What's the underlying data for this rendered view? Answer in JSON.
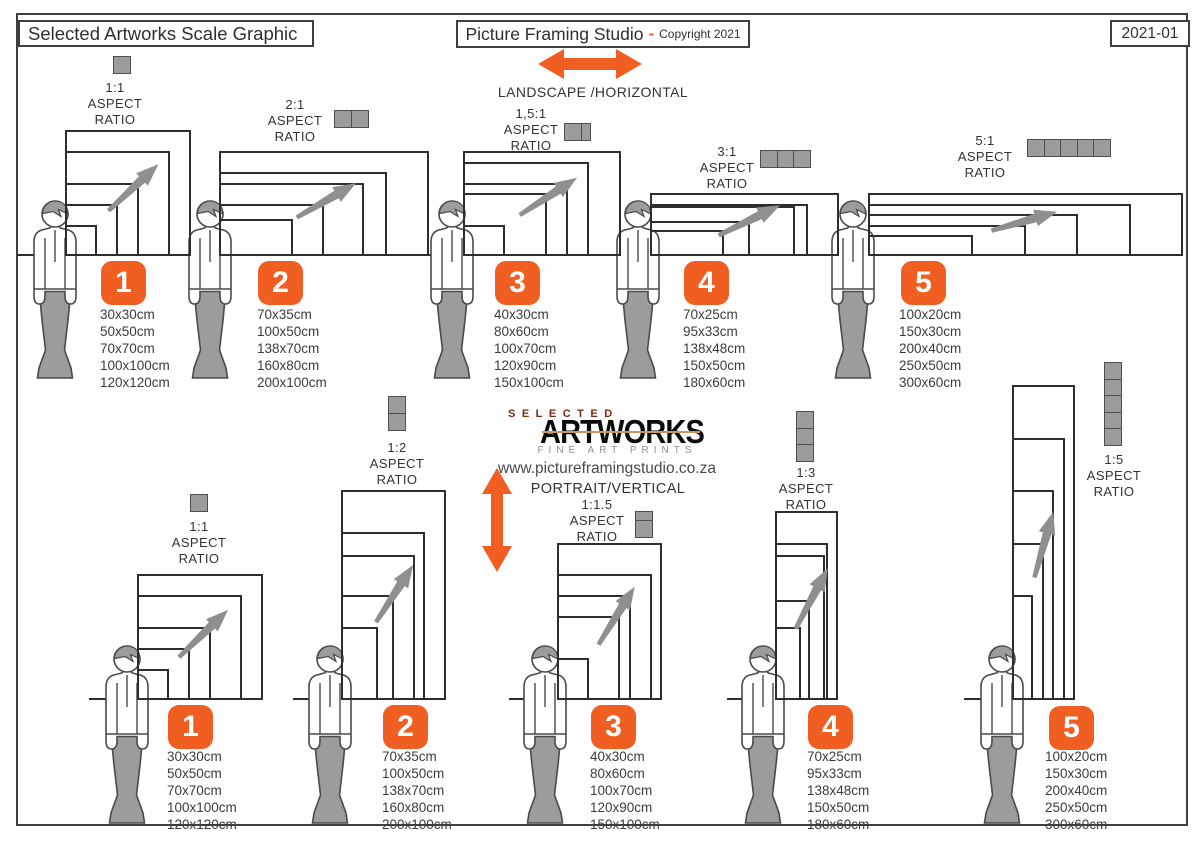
{
  "header": {
    "left_title": "Selected Artworks Scale Graphic",
    "studio_title": "Picture Framing Studio",
    "studio_sep": "-",
    "copyright": "Copyright 2021",
    "doc_code": "2021-01"
  },
  "top_section": {
    "label": "LANDSCAPE /HORIZONTAL"
  },
  "bottom_section": {
    "label": "PORTRAIT/VERTICAL"
  },
  "brand": {
    "line1": "SELECTED",
    "line2": "ARTWORKS",
    "line3": "FINE ART PRINTS",
    "website": "www.pictureframingstudio.co.za"
  },
  "aspect_words": {
    "aspect": "ASPECT",
    "ratio": "RATIO"
  },
  "landscape_groups": [
    {
      "number": "1",
      "ratio_label": "1:1",
      "units": 1,
      "sizes": [
        "30x30cm",
        "50x50cm",
        "70x70cm",
        "100x100cm",
        "120x120cm"
      ]
    },
    {
      "number": "2",
      "ratio_label": "2:1",
      "units": 2,
      "sizes": [
        "70x35cm",
        "100x50cm",
        "138x70cm",
        "160x80cm",
        "200x100cm"
      ]
    },
    {
      "number": "3",
      "ratio_label": "1,5:1",
      "units": 1.5,
      "sizes": [
        "40x30cm",
        "80x60cm",
        "100x70cm",
        "120x90cm",
        "150x100cm"
      ]
    },
    {
      "number": "4",
      "ratio_label": "3:1",
      "units": 3,
      "sizes": [
        "70x25cm",
        "95x33cm",
        "138x48cm",
        "150x50cm",
        "180x60cm"
      ]
    },
    {
      "number": "5",
      "ratio_label": "5:1",
      "units": 5,
      "sizes": [
        "100x20cm",
        "150x30cm",
        "200x40cm",
        "250x50cm",
        "300x60cm"
      ]
    }
  ],
  "portrait_groups": [
    {
      "number": "1",
      "ratio_label": "1:1",
      "units": 1,
      "sizes": [
        "30x30cm",
        "50x50cm",
        "70x70cm",
        "100x100cm",
        "120x120cm"
      ]
    },
    {
      "number": "2",
      "ratio_label": "1:2",
      "units": 2,
      "sizes": [
        "70x35cm",
        "100x50cm",
        "138x70cm",
        "160x80cm",
        "200x100cm"
      ]
    },
    {
      "number": "3",
      "ratio_label": "1:1.5",
      "units": 1.5,
      "sizes": [
        "40x30cm",
        "80x60cm",
        "100x70cm",
        "120x90cm",
        "150x100cm"
      ]
    },
    {
      "number": "4",
      "ratio_label": "1:3",
      "units": 3,
      "sizes": [
        "70x25cm",
        "95x33cm",
        "138x48cm",
        "150x50cm",
        "180x60cm"
      ]
    },
    {
      "number": "5",
      "ratio_label": "1:5",
      "units": 5,
      "sizes": [
        "100x20cm",
        "150x30cm",
        "200x40cm",
        "250x50cm",
        "300x60cm"
      ]
    }
  ],
  "colors": {
    "accent": "#F15E22",
    "figure_gray": "#9C9C9C",
    "arrow_gray": "#8F8F8F",
    "frame_line": "#2E2E2E",
    "logo_red": "#7E2810",
    "logo_gray": "#909090"
  }
}
